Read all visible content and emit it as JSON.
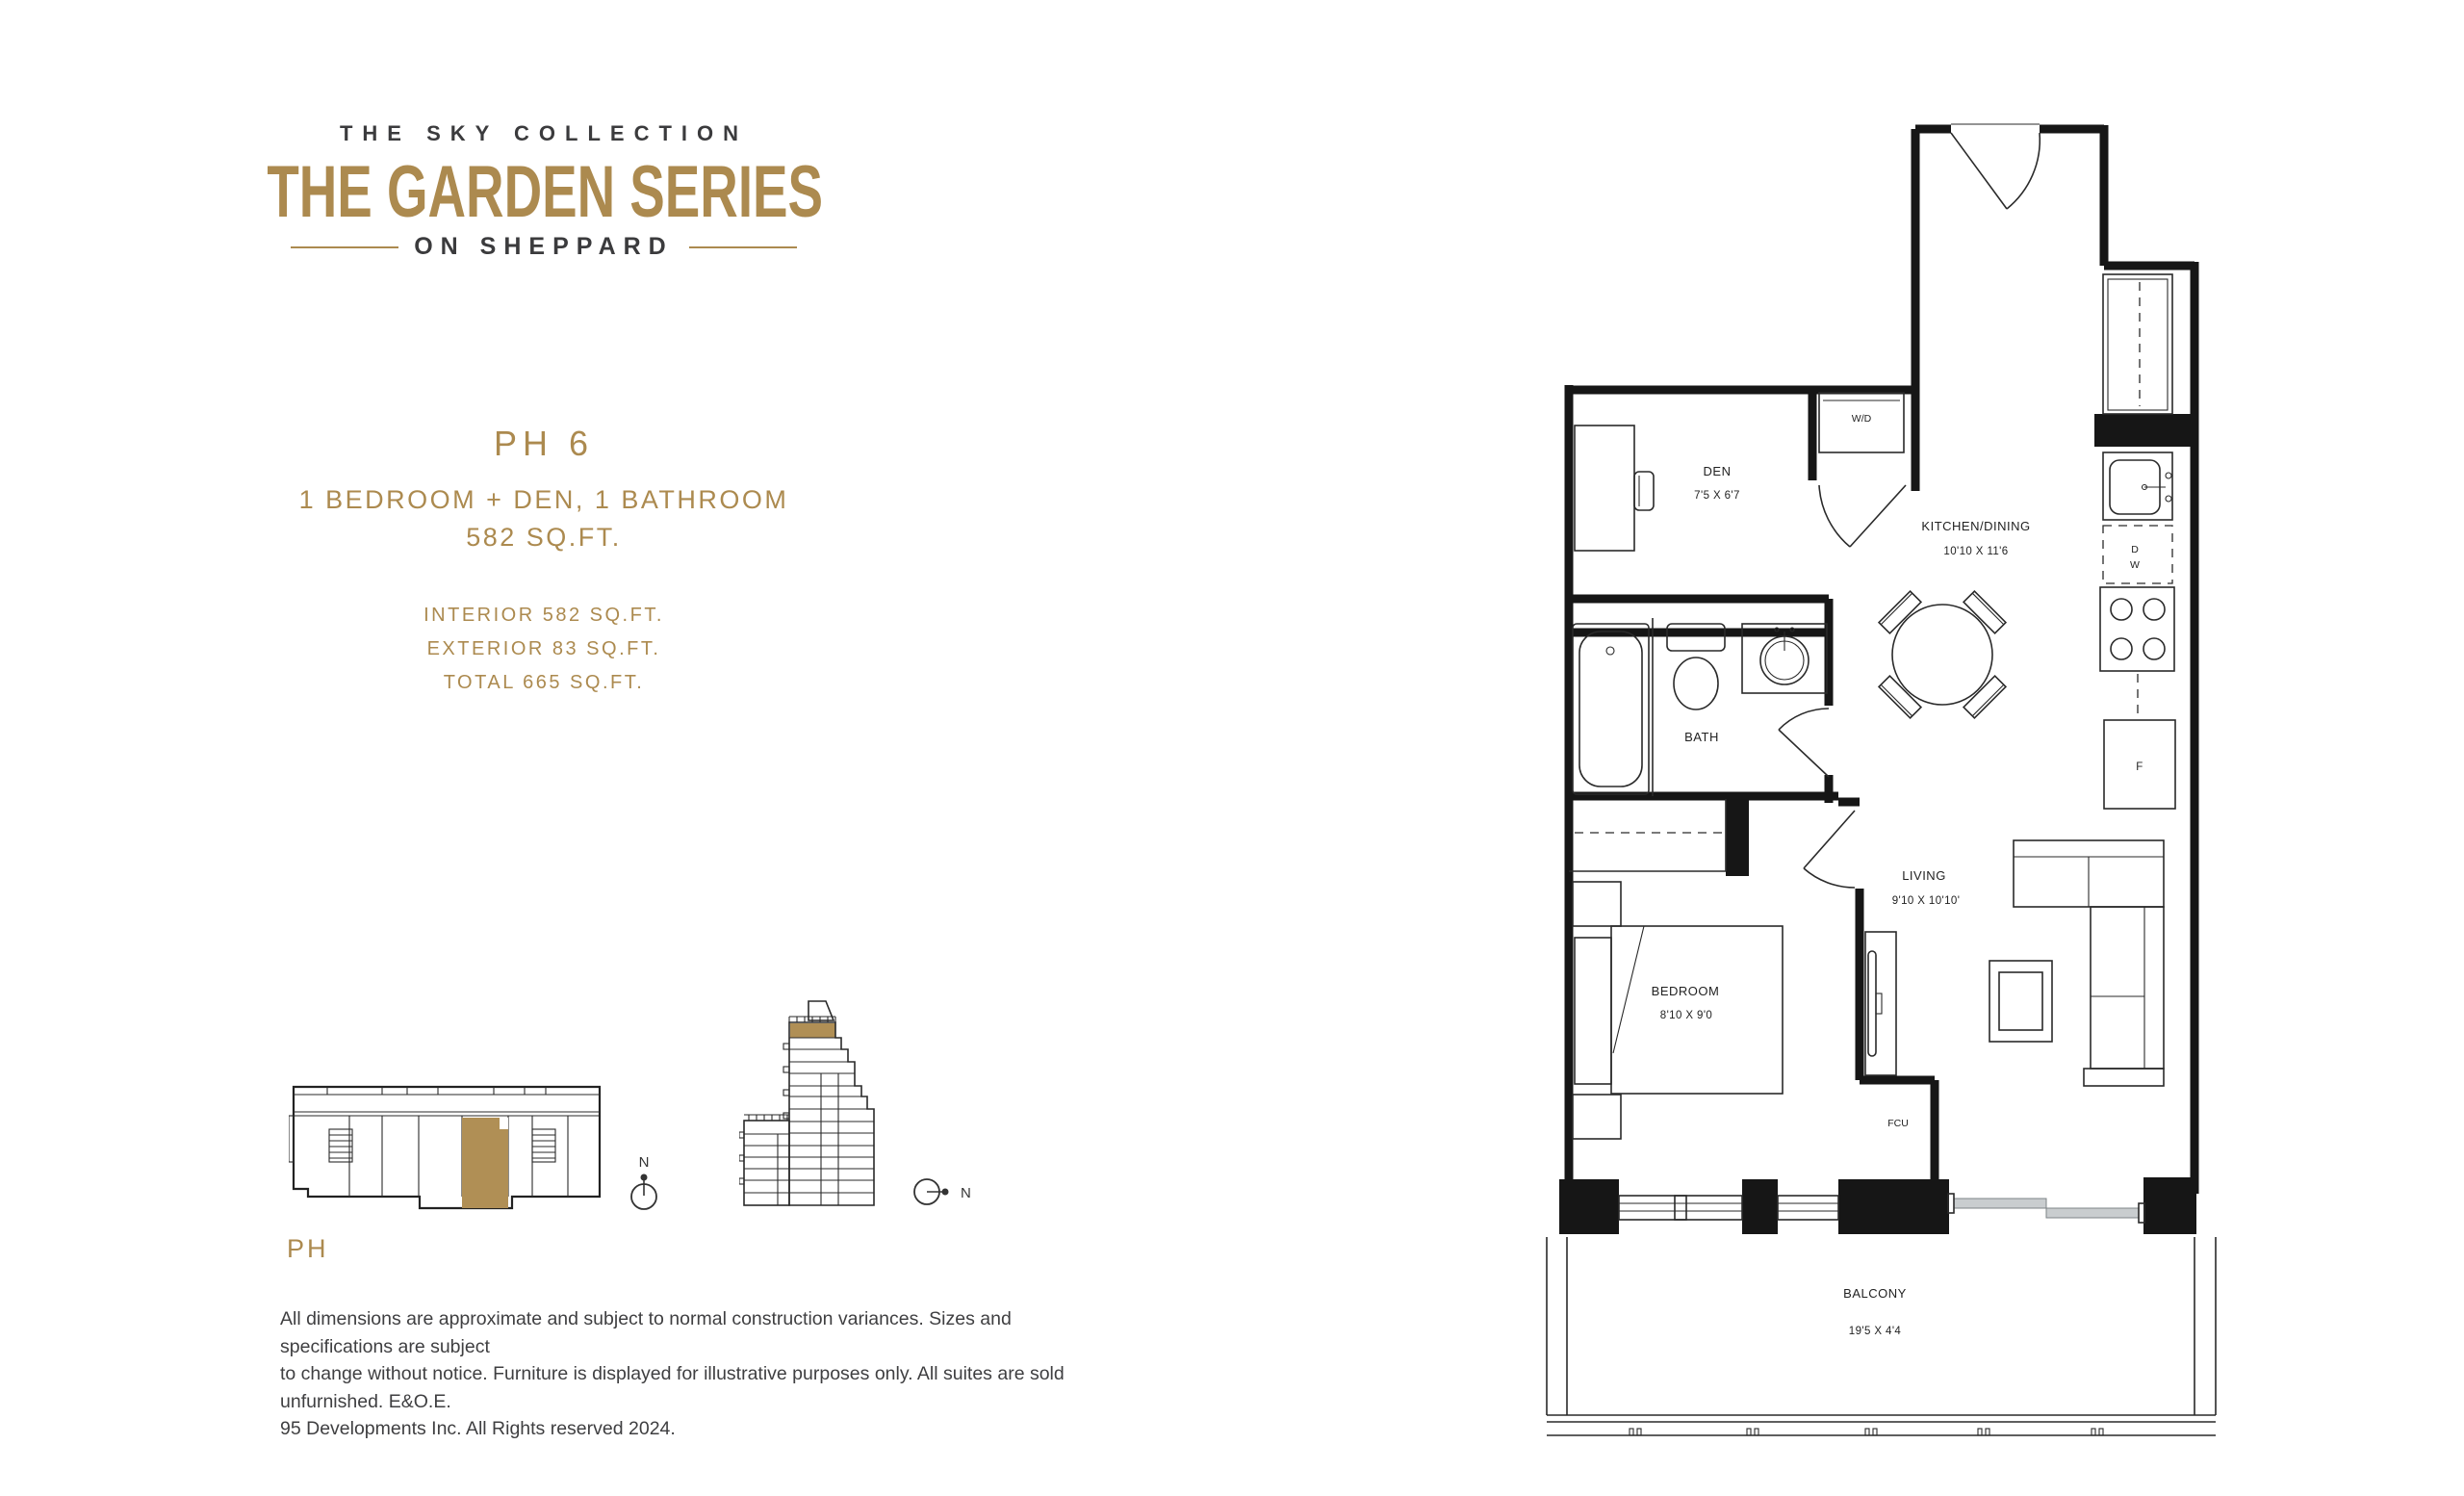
{
  "brand": {
    "collection": "THE SKY COLLECTION",
    "series": "THE GARDEN SERIES",
    "tagline": "ON SHEPPARD"
  },
  "unit": {
    "name": "PH 6",
    "type": "1 BEDROOM + DEN, 1 BATHROOM",
    "area": "582 SQ.FT.",
    "interior": "INTERIOR 582 SQ.FT.",
    "exterior": "EXTERIOR 83 SQ.FT.",
    "total": "TOTAL 665 SQ.FT."
  },
  "keyplan": {
    "floor_label": "PH",
    "compass_north": "N"
  },
  "floorplan": {
    "den": {
      "name": "DEN",
      "dims": "7'5 X 6'7"
    },
    "kitchen": {
      "name": "KITCHEN/DINING",
      "dims": "10'10 X 11'6"
    },
    "bath": {
      "name": "BATH"
    },
    "living": {
      "name": "LIVING",
      "dims": "9'10 X 10'10'"
    },
    "bedroom": {
      "name": "BEDROOM",
      "dims": "8'10 X 9'0"
    },
    "balcony": {
      "name": "BALCONY",
      "dims": "19'5 X 4'4"
    },
    "washer_dryer": "W/D",
    "dishwasher_d": "D",
    "dishwasher_w": "W",
    "fridge": "F",
    "fcu": "FCU"
  },
  "footer": {
    "lines": [
      "All dimensions are approximate and subject to normal construction variances. Sizes and specifications are subject",
      "to change without notice. Furniture is displayed for illustrative purposes only. All suites are sold unfurnished. E&O.E.",
      "95 Developments Inc. All Rights reserved 2024."
    ]
  },
  "colors": {
    "gold": "#AC8A4F",
    "gold_fill": "#B08F55",
    "ink": "#3B3B3D",
    "plan_line": "#161616"
  }
}
